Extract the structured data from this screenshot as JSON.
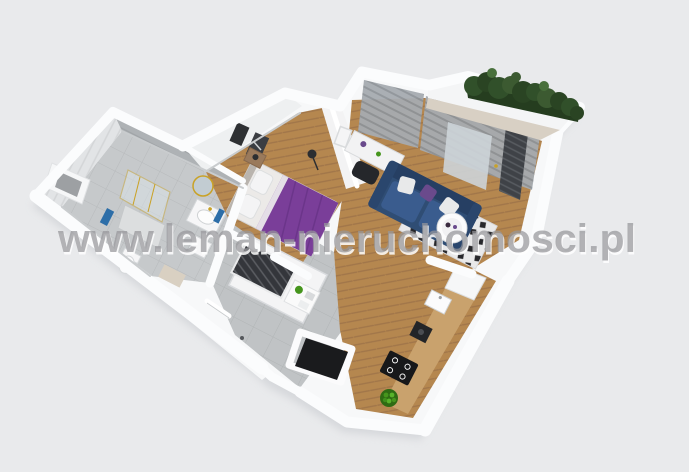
{
  "watermark": {
    "text": "www.leman-nieruchomosci.pl"
  },
  "scene": {
    "background": "#e9eaec",
    "wall": "#f7f8f9",
    "wall_edge": "#ffffff",
    "colors": {
      "bathroom_tile_floor": "#c6c9cb",
      "bathroom_wall_light": "#e2e4e6",
      "bathroom_wall_gray": "#aeb2b5",
      "hall_tile": "#c0c3c5",
      "wood": "#b5874f",
      "wood_dark": "#a1764a",
      "counter_wood": "#c9a26d",
      "bed_purple": "#7a3e99",
      "sofa_navy": "#2f4d74",
      "sofa_cushion": "#3a5c8e",
      "pillow_purple": "#6a4a8c",
      "rug_base": "#e9e9ea",
      "rug_dark": "#27272b",
      "hedge_green": "#31502a",
      "hedge_light": "#49703c",
      "curtain_gray": "#a6abb0",
      "radiator_dark": "#3f4247",
      "shaft_dark": "#1a1b1d",
      "clothes_dark": "#34363b",
      "towel_blue": "#2d6ea8",
      "gold": "#c9a227",
      "fruit_green": "#46951d",
      "chair_black": "#25272b",
      "lamp_black": "#2c2e31",
      "watermark_gray": "#97979b",
      "shadow": "#c6c9ce"
    },
    "objects": [
      "bathroom",
      "bedroom",
      "living-room",
      "kitchen",
      "hallway",
      "wardrobe",
      "balcony-hedge",
      "entry-door"
    ]
  }
}
